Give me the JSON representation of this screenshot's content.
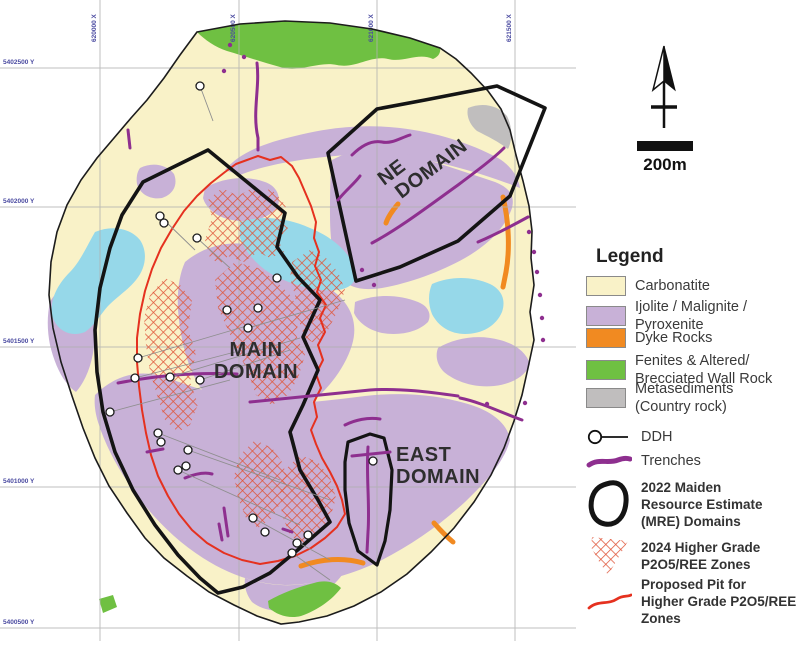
{
  "map_labels": {
    "main_domain": [
      "MAIN",
      "DOMAIN"
    ],
    "ne_domain": [
      "NE",
      "DOMAIN"
    ],
    "east_domain": [
      "EAST",
      "DOMAIN"
    ]
  },
  "grid": {
    "x_labels": [
      "620000 X",
      "620500 X",
      "621000 X",
      "621500 X"
    ],
    "y_labels": [
      "5402500 Y",
      "5402000 Y",
      "5401500 Y",
      "5401000 Y",
      "5400500 Y"
    ]
  },
  "north_scale": {
    "scale_label": "200m"
  },
  "colors": {
    "carbonatite": "#F9F2C8",
    "ijolite": "#C8B1D7",
    "dyke": "#F18A21",
    "fenites": "#6FC042",
    "metasediments": "#C0BEBE",
    "water_blue": "#96D8E9",
    "hatch": "#E0563A",
    "pit": "#E5311F",
    "trench": "#8E2F8F",
    "mre": "#141414",
    "outline": "#1C1C1C",
    "grid_line": "#B0B0B0",
    "grid_label": "#4A4AA0",
    "ddh_leader": "#8F8F8F"
  },
  "legend": {
    "title": "Legend",
    "items": [
      {
        "label": "Carbonatite"
      },
      {
        "lines": [
          "Ijolite / Malignite /",
          "Pyroxenite"
        ]
      },
      {
        "label": "Dyke Rocks"
      },
      {
        "lines": [
          "Fenites & Altered/",
          "Brecciated Wall Rock"
        ]
      },
      {
        "lines": [
          "Metasediments",
          "(Country rock)"
        ]
      },
      {
        "label": "DDH"
      },
      {
        "label": "Trenches"
      },
      {
        "lines": [
          "2022 Maiden",
          "Resource Estimate",
          "(MRE) Domains"
        ]
      },
      {
        "lines": [
          "2024 Higher Grade",
          "P2O5/REE Zones"
        ]
      },
      {
        "lines": [
          "Proposed Pit for",
          "Higher Grade P2O5/REE",
          "Zones"
        ]
      }
    ]
  }
}
